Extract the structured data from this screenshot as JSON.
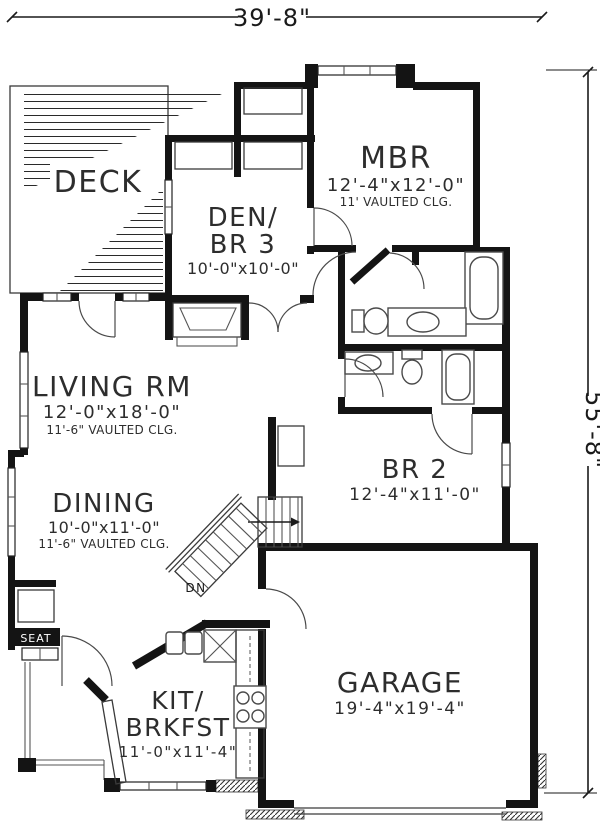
{
  "plan": {
    "title": "single-story house first floor plan",
    "colors": {
      "ink": "#141414",
      "background": "#ffffff",
      "fixture_line": "#4a4a4a"
    }
  },
  "dimensions": {
    "width_label": "39'-8\"",
    "height_label": "55'-8\""
  },
  "rooms": {
    "deck": {
      "label": "DECK"
    },
    "den": {
      "line1": "DEN/",
      "line2": "BR 3",
      "size": "10'-0\"x10'-0\""
    },
    "mbr": {
      "label": "MBR",
      "size": "12'-4\"x12'-0\"",
      "note": "11' VAULTED CLG."
    },
    "living": {
      "label": "LIVING RM",
      "size": "12'-0\"x18'-0\"",
      "note": "11'-6\" VAULTED CLG."
    },
    "dining": {
      "label": "DINING",
      "size": "10'-0\"x11'-0\"",
      "note": "11'-6\" VAULTED CLG."
    },
    "br2": {
      "label": "BR 2",
      "size": "12'-4\"x11'-0\""
    },
    "garage": {
      "label": "GARAGE",
      "size": "19'-4\"x19'-4\""
    },
    "kit": {
      "line1": "KIT/",
      "line2": "BRKFST",
      "size": "11'-0\"x11'-4\""
    }
  },
  "annotations": {
    "stairs_down": "DN",
    "window_seat": "SEAT"
  }
}
